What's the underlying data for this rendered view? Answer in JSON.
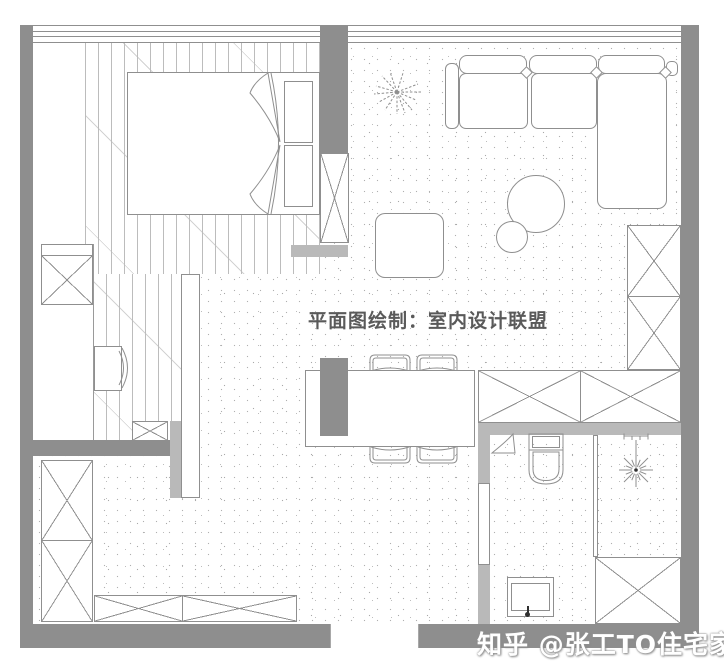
{
  "caption": {
    "text": "平面图绘制：室内设计联盟"
  },
  "watermark": {
    "text": "知乎 @张工TO住宅家具"
  },
  "colors": {
    "wall_dark": "#8e8e8e",
    "wall_light": "#b9b9b9",
    "line": "#8f8f8f",
    "shower_ink": "#2f2f2f",
    "caption": "#5a5a5a",
    "watermark": "#ffffff",
    "background": "#ffffff"
  },
  "icons": {
    "plant": "plant-icon",
    "shower": "shower-head-icon",
    "toilet": "toilet-icon",
    "quilt": "bed-quilt-icon",
    "chair": "chair-icon"
  }
}
